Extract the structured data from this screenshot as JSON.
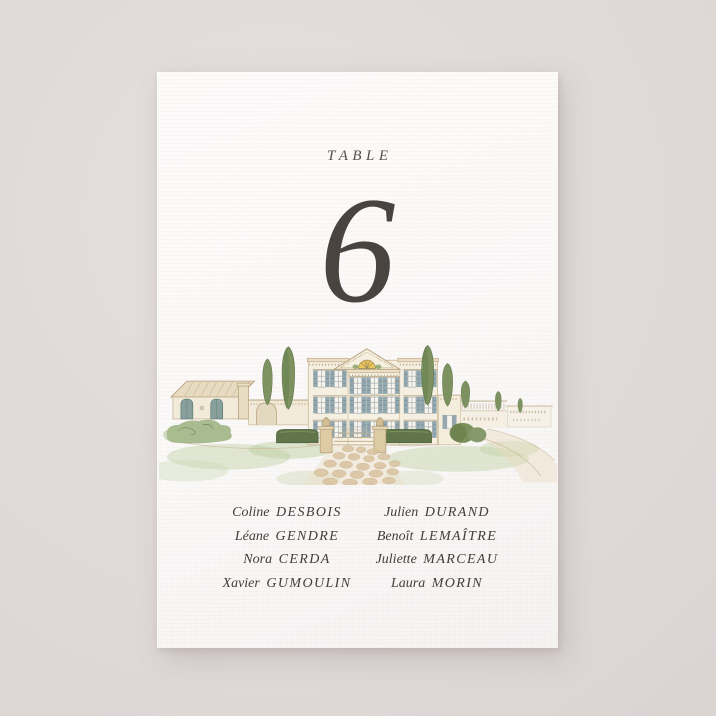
{
  "background": {
    "color": "#ddd7d6"
  },
  "card": {
    "paper_color": "#fbfaf9",
    "text_color": "#413e3a",
    "header": {
      "label": "TABLE"
    },
    "table_number": "6",
    "illustration": {
      "name": "watercolor-chateau",
      "alt": "Watercolor painting of a French chateau with pediment and fanlight, shuttered windows, cypress trees, boxwood hedges, entrance pillars, stone path, side barn and balustrade wall",
      "palette": {
        "wall": "#f5efe1",
        "trim": "#b8a37e",
        "shutter": "#93a7ae",
        "fanlight": "#e9c75e",
        "cypress": "#7d9260",
        "hedge": "#60754a",
        "lawn": "#c6d4ac",
        "path_stone": "#d9c3a0"
      }
    },
    "guests": {
      "columns": [
        {
          "items": [
            {
              "first": "Coline",
              "last": "DESBOIS"
            },
            {
              "first": "Léane",
              "last": "GENDRE"
            },
            {
              "first": "Nora",
              "last": "CERDA"
            },
            {
              "first": "Xavier",
              "last": "GUMOULIN"
            }
          ]
        },
        {
          "items": [
            {
              "first": "Julien",
              "last": "DURAND"
            },
            {
              "first": "Benoît",
              "last": "LEMAÎTRE"
            },
            {
              "first": "Juliette",
              "last": "MARCEAU"
            },
            {
              "first": "Laura",
              "last": "MORIN"
            }
          ]
        }
      ]
    }
  }
}
